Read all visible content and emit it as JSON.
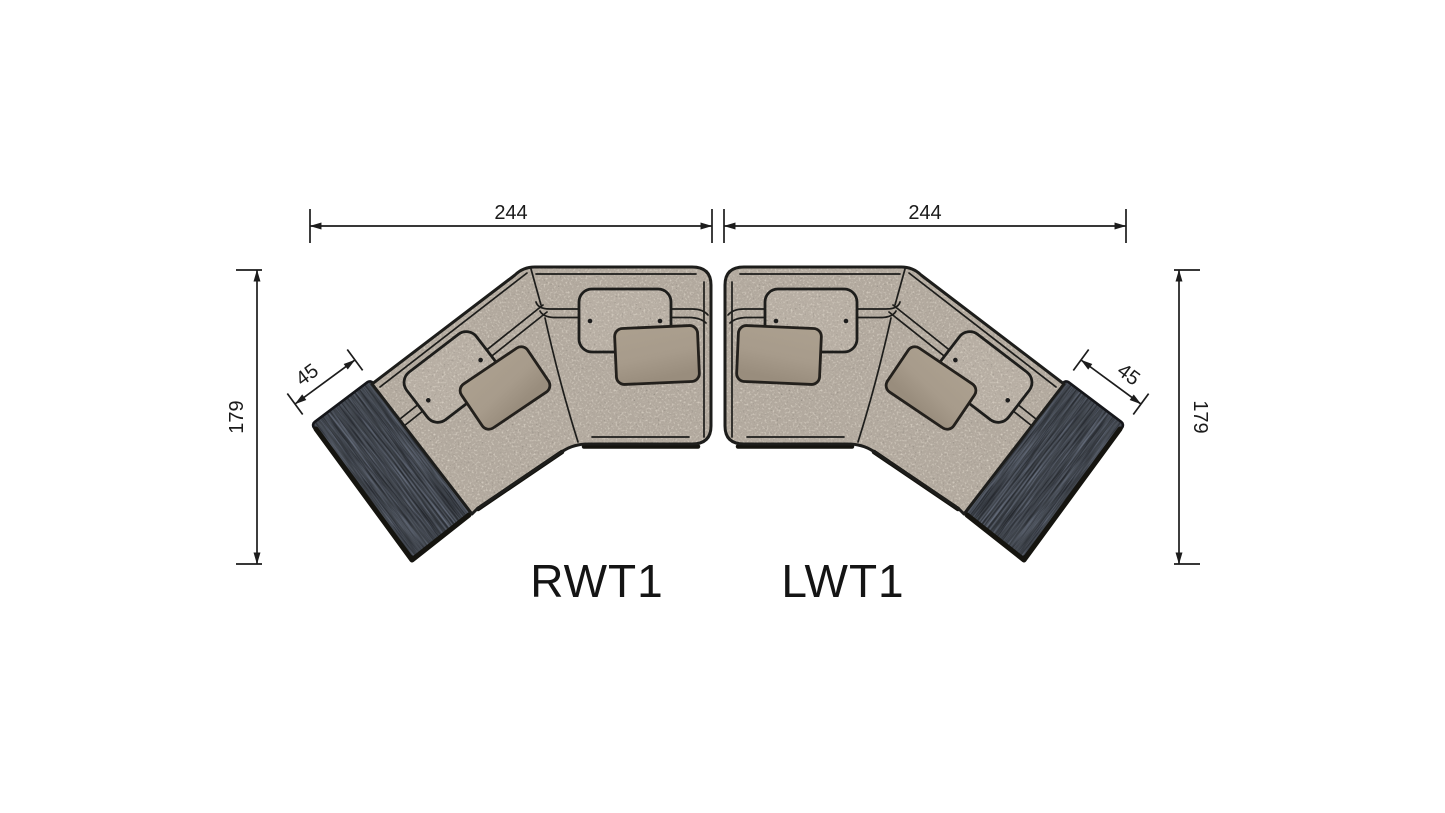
{
  "diagram": {
    "type": "sectional-sofa-top-view-dimension-drawing",
    "labels": {
      "left_piece": "RWT1",
      "right_piece": "LWT1"
    },
    "dimensions": {
      "top_left": "244",
      "top_right": "244",
      "side_left": "179",
      "side_right": "179",
      "table_left": "45",
      "table_right": "45"
    },
    "pieces": [
      {
        "code": "RWT1",
        "width": "244",
        "depth": "179",
        "table_width": "45"
      },
      {
        "code": "LWT1",
        "width": "244",
        "depth": "179",
        "table_width": "45"
      }
    ],
    "colors": {
      "background": "#ffffff",
      "outline": "#1d1d1b",
      "fabric_base": "#b2a99e",
      "fabric_speckle_light": "#d6cfc5",
      "fabric_speckle_dark": "#7b766e",
      "headrest_fabric": "#b7aea3",
      "pillow": "#a79b8b",
      "table_wood": "#3e434a",
      "dimension_line": "#1c1c1c"
    }
  }
}
